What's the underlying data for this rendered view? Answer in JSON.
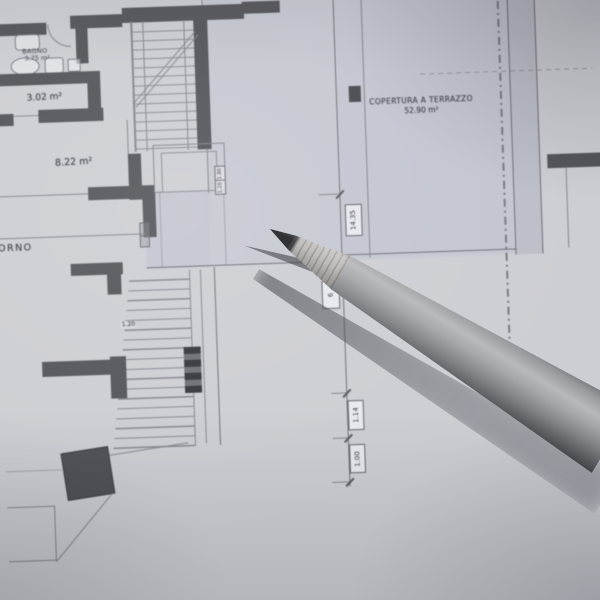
{
  "plan": {
    "terrace": {
      "title": "COPERTURA A TERRAZZO",
      "area": "52.90 m²"
    },
    "rooms": {
      "bagno_label": "BAGNO",
      "bagno_area": "3.75 m²",
      "room_a_area": "3.02 m²",
      "room_b_area": "8.22 m²",
      "giorno_partial": "ORNO"
    },
    "dimensions": {
      "total": "14.35",
      "hidden_segment": "6",
      "seg_a": "1.14",
      "seg_b": "1.00",
      "stair_width": "1.20",
      "landing_a": "1.80",
      "landing_b": "1.20"
    },
    "colors": {
      "paper": "#cdced3",
      "terrace_shade": "#c7c9d2",
      "wall": "#54555a",
      "line": "#84858b",
      "graphite": "#17181b",
      "pencil_wood": "#b3b1ad",
      "pencil_body": "#9d9ea1"
    }
  }
}
